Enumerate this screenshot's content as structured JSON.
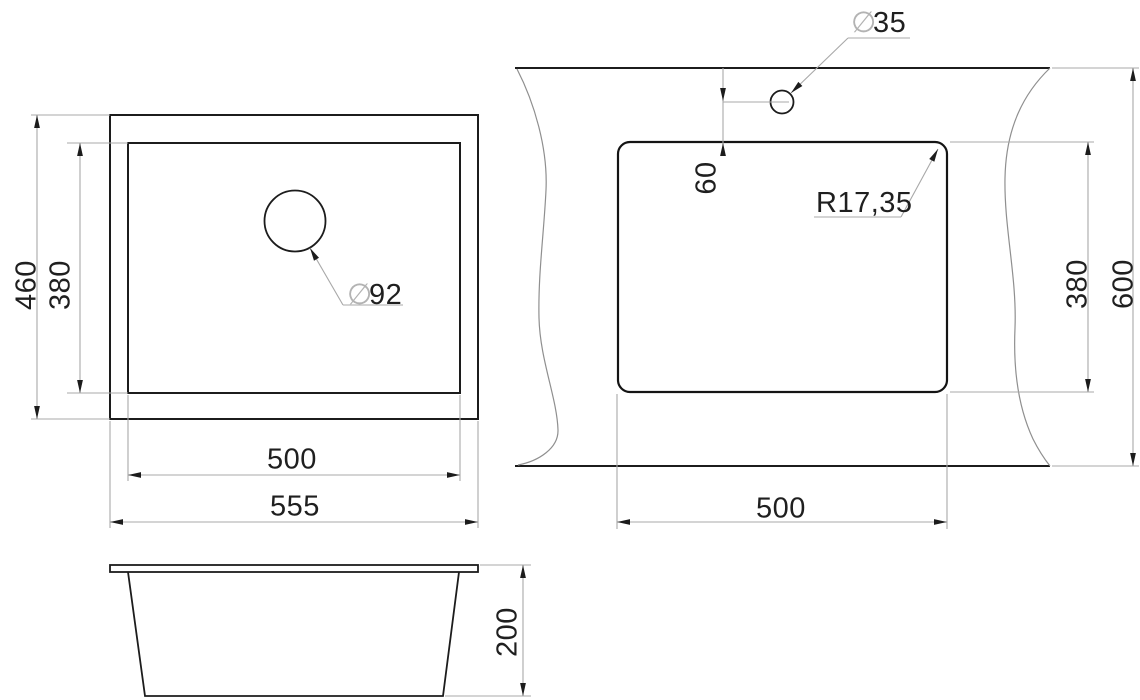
{
  "drawing": {
    "type": "sink installation dimension drawing",
    "colors": {
      "background": "#ffffff",
      "outline": "#1c1c1c",
      "dimension_line": "#a8a8a8",
      "wave_line": "#8f8f8f",
      "text": "#1f1f1f",
      "diameter_symbol": "#b3b3b3"
    },
    "views": {
      "top": {
        "dims": {
          "outer_height": "460",
          "inner_height": "380",
          "inner_width": "500",
          "outer_width": "555",
          "drain_symbol": "∅",
          "drain_value": "92"
        }
      },
      "cutout": {
        "dims": {
          "hole_symbol": "∅",
          "hole_value": "35",
          "hole_offset": "60",
          "corner_radius": "R17,35",
          "cutout_height": "380",
          "counter_height": "600",
          "cutout_width": "500"
        }
      },
      "side": {
        "dims": {
          "depth": "200"
        }
      }
    }
  }
}
